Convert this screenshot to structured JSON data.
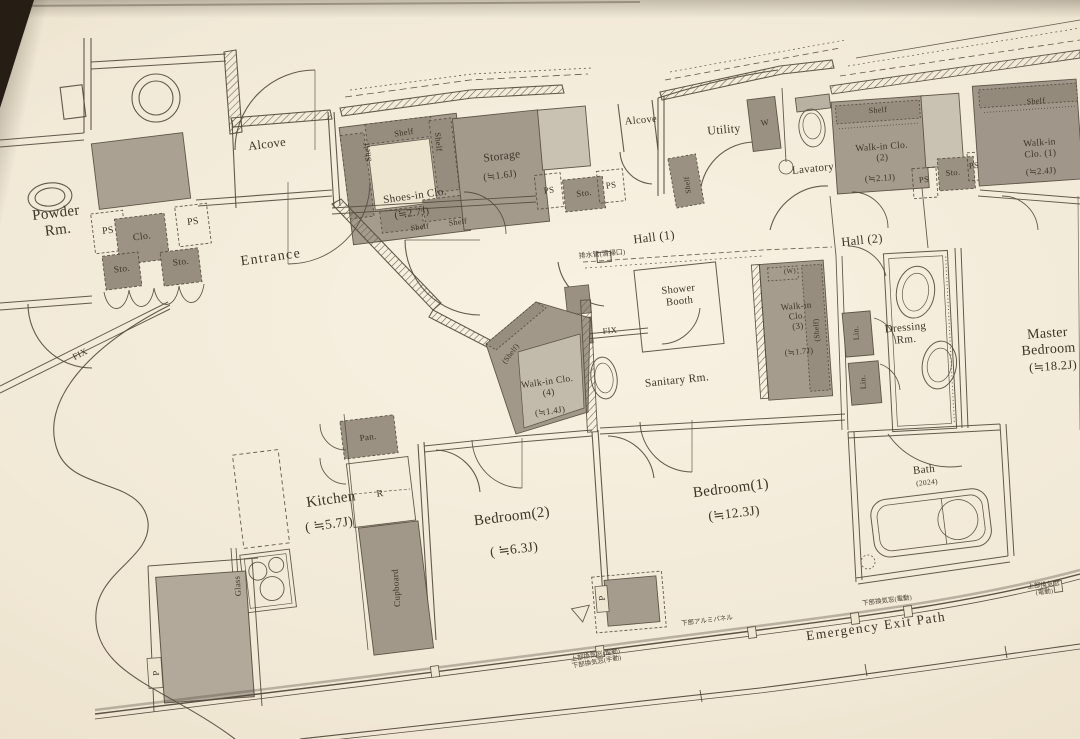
{
  "rooms": {
    "powder_rm": "Powder\nRm.",
    "entrance": "Entrance",
    "alcove": "Alcove",
    "shoes_in_clo": "Shoes-in Clo.",
    "shoes_in_clo_area": "(≒2.7J)",
    "storage": "Storage",
    "storage_area": "(≒1.6J)",
    "utility": "Utility",
    "lavatory": "Lavatory",
    "walk_in_clo_1": "Walk-in Clo. (1)",
    "walk_in_clo_1_area": "(≒2.4J)",
    "walk_in_clo_2": "Walk-in Clo.\n(2)",
    "walk_in_clo_2_area": "(≒2.1J)",
    "walk_in_clo_3": "Walk-in\nClo.\n(3)",
    "walk_in_clo_3_area": "(≒1.7J)",
    "walk_in_clo_4": "Walk-in Clo.\n(4)",
    "walk_in_clo_4_area": "(≒1.4J)",
    "hall_1": "Hall (1)",
    "hall_2": "Hall (2)",
    "shower_booth": "Shower\nBooth",
    "sanitary_rm": "Sanitary Rm.",
    "dressing_rm": "Dressing\nRm.",
    "master_bedroom": "Master Bedroom",
    "master_bedroom_area": "(≒18.2J)",
    "kitchen": "Kitchen",
    "kitchen_area": "( ≒5.7J)",
    "bedroom_2": "Bedroom(2)",
    "bedroom_2_area": "( ≒6.3J)",
    "bedroom_1": "Bedroom(1)",
    "bedroom_1_area": "(≒12.3J)",
    "bath": "Bath",
    "bath_size": "(2024)",
    "emergency_exit_path": "Emergency Exit Path"
  },
  "fixtures": {
    "ps": "PS",
    "sto": "Sto.",
    "clo": "Clo.",
    "shelf": "Shelf",
    "shelf_paren": "(Shelf)",
    "pan": "Pan.",
    "r": "R",
    "w": "W",
    "w_paren": "(W)",
    "lin": "Lin.",
    "cupboard": "Cupboard",
    "glass": "Glass",
    "p": "P",
    "fix": "FIX"
  },
  "annotations": {
    "drain": "排水管(清掃口)",
    "alumi_panel": "下部アルミパネル",
    "vent_lower": "下部換気窓(電動)",
    "vent_upper": "上部換気窓(電動)",
    "vent_two_line": "上部換気窓(電動)\n下部換気窓(手動)"
  },
  "palette": {
    "paper": "#efe6d2",
    "line": "#53493c",
    "gray_dark": "#a59c8e",
    "gray_light": "#c9c1b2",
    "text": "#3e3428"
  }
}
